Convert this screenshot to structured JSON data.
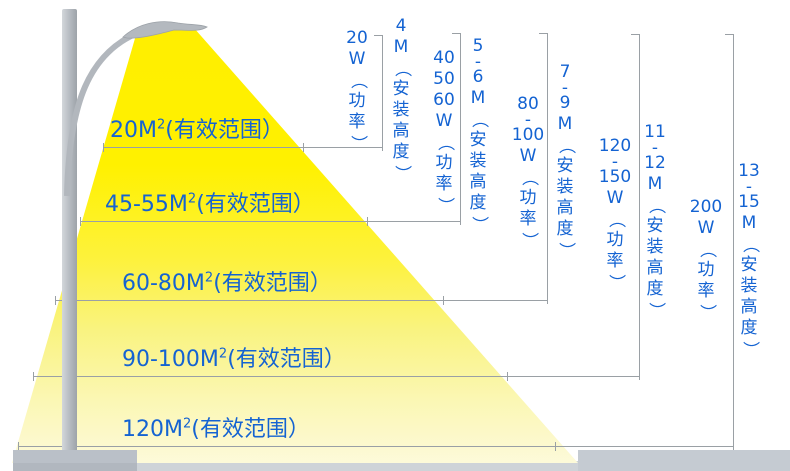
{
  "colors": {
    "blue": "#1463d2",
    "line": "#9aa0a5",
    "cone_top": "#fff100",
    "cone_bottom": "#fdfade",
    "pole_gray": "#b4b9bf",
    "ground_gray": "#c5cbd2"
  },
  "rows": [
    {
      "area": {
        "num": "20M",
        "sup": "2",
        "rest": "(有效范围）"
      },
      "power": "20W（功率）",
      "power_lines": [
        "20",
        "W",
        "（",
        "功",
        "率",
        "）"
      ],
      "height": "4M（安装高度）",
      "height_lines": [
        "4",
        "M",
        "（",
        "安",
        "装",
        "高",
        "度",
        "）"
      ]
    },
    {
      "area": {
        "num": "45-55M",
        "sup": "2",
        "rest": "(有效范围）"
      },
      "power": "40 50 60W（功率）",
      "power_lines": [
        "40",
        "50",
        "60",
        "W",
        "（",
        "功",
        "率",
        "）"
      ],
      "height": "5-6M（安装高度）",
      "height_lines": [
        "5",
        "-",
        "6",
        "M",
        "（",
        "安",
        "装",
        "高",
        "度",
        "）"
      ]
    },
    {
      "area": {
        "num": "60-80M",
        "sup": "2",
        "rest": "(有效范围）"
      },
      "power": "80-100W（功率）",
      "power_lines": [
        "80",
        "-",
        "100",
        "W",
        "（",
        "功",
        "率",
        "）"
      ],
      "height": "7-9M（安装高度）",
      "height_lines": [
        "7",
        "-",
        "9",
        "M",
        "（",
        "安",
        "装",
        "高",
        "度",
        "）"
      ]
    },
    {
      "area": {
        "num": "90-100M",
        "sup": "2",
        "rest": "(有效范围）"
      },
      "power": "120-150W（功率）",
      "power_lines": [
        "120",
        "-",
        "150",
        "W",
        "（",
        "功",
        "率",
        "）"
      ],
      "height": "11-12M（安装高度）",
      "height_lines": [
        "11",
        "-",
        "12",
        "M",
        "（",
        "安",
        "装",
        "高",
        "度",
        "）"
      ]
    },
    {
      "area": {
        "num": "120M",
        "sup": "2",
        "rest": "(有效范围）"
      },
      "power": "200W（功率）",
      "power_lines": [
        "200",
        "W",
        "（",
        "功",
        "率",
        "）"
      ],
      "height": "13-15M（安装高度）",
      "height_lines": [
        "13",
        "-",
        "15",
        "M",
        "（",
        "安",
        "装",
        "高",
        "度",
        "）"
      ]
    }
  ]
}
